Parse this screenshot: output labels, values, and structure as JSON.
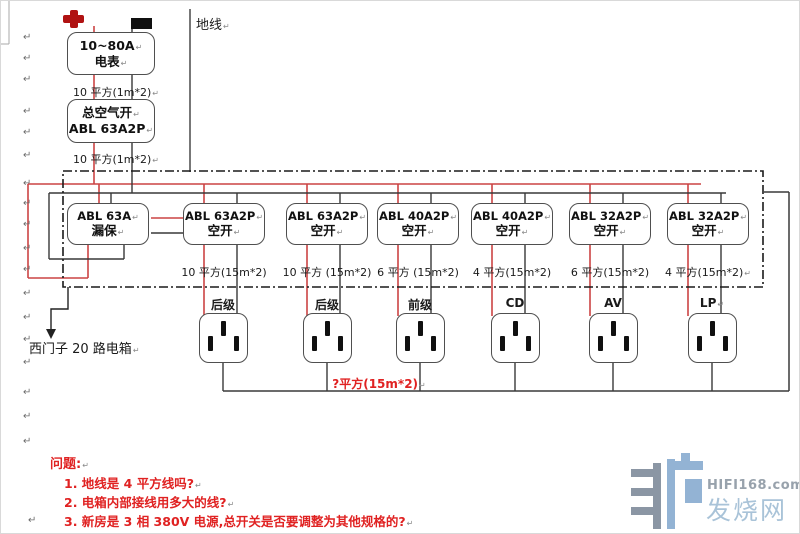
{
  "page": {
    "paragraph_mark": "↵"
  },
  "top": {
    "ground_label": "地线",
    "meter": {
      "line1": "10~80A",
      "line2": "电表"
    },
    "wire_meter_to_main": "10 平方(1m*2)",
    "main_breaker": {
      "line1": "总空气开",
      "line2": "ABL 63A2P"
    },
    "wire_main_to_panel": "10 平方(1m*2)"
  },
  "panel": {
    "box_label": "西门子 20 路电箱",
    "breakers": [
      {
        "line1": "ABL 63A",
        "line2": "漏保"
      },
      {
        "line1": "ABL 63A2P",
        "line2": "空开",
        "wire": "10 平方(15m*2)"
      },
      {
        "line1": "ABL 63A2P",
        "line2": "空开",
        "wire": "10 平方 (15m*2)"
      },
      {
        "line1": "ABL 40A2P",
        "line2": "空开",
        "wire": "6 平方 (15m*2)"
      },
      {
        "line1": "ABL 40A2P",
        "line2": "空开",
        "wire": "4 平方(15m*2)"
      },
      {
        "line1": "ABL 32A2P",
        "line2": "空开",
        "wire": "6 平方(15m*2)"
      },
      {
        "line1": "ABL 32A2P",
        "line2": "空开",
        "wire": "4 平方(15m*2)"
      }
    ]
  },
  "outlets": {
    "labels": [
      "后级",
      "后级",
      "前级",
      "CD",
      "AV",
      "LP"
    ],
    "ground_bus_label": "?平方(15m*2)"
  },
  "questions": {
    "title": "问题:",
    "items": [
      "1. 地线是 4 平方线吗?",
      "2. 电箱内部接线用多大的线?",
      "3. 新房是 3 相 380V 电源,总开关是否要调整为其他规格的?"
    ]
  },
  "watermark": {
    "site": "HIFI168.com",
    "name": "发烧网"
  },
  "colors": {
    "wire_live": "#cc4444",
    "wire_neutral": "#383838",
    "wire_ground": "#4a4a4a",
    "question_red": "#e02222",
    "live_icon_red": "#b01212"
  }
}
